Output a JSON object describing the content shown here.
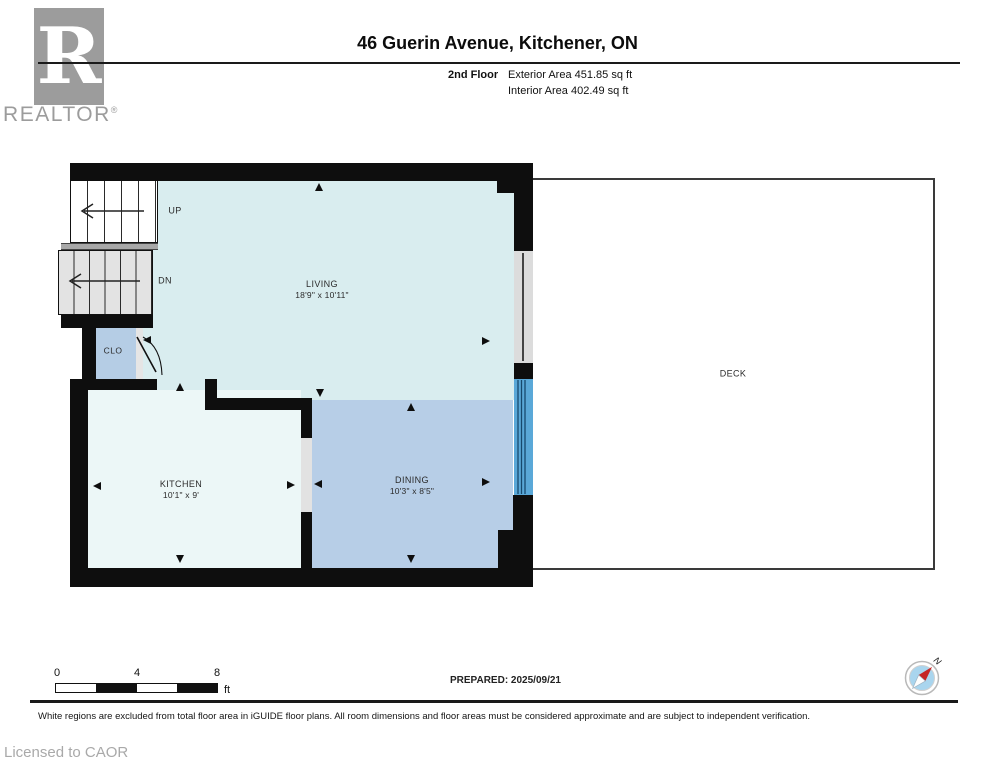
{
  "header": {
    "logo": {
      "letter": "R",
      "brand": "REALTOR",
      "registered": "®"
    },
    "title": "46 Guerin Avenue, Kitchener, ON",
    "floor_label": "2nd Floor",
    "exterior_area": "Exterior Area 451.85 sq ft",
    "interior_area": "Interior Area 402.49 sq ft"
  },
  "floor_plan": {
    "rooms": {
      "living": {
        "name": "LIVING",
        "dims": "18'9\" x 10'11\""
      },
      "dining": {
        "name": "DINING",
        "dims": "10'3\" x 8'5\""
      },
      "kitchen": {
        "name": "KITCHEN",
        "dims": "10'1\" x 9'"
      },
      "closet": {
        "name": "CLO"
      },
      "deck": {
        "name": "DECK"
      }
    },
    "stairs": {
      "up_label": "UP",
      "dn_label": "DN"
    },
    "colors": {
      "living": "#d9edef",
      "dining": "#b7cee7",
      "kitchen": "#ecf7f7",
      "closet": "#b5cde5",
      "sliding_door": "#5aa8d8",
      "window": "#dcdcdc",
      "wall": "#0e0e0e",
      "compass_needle": "#c52525"
    }
  },
  "footer": {
    "scale": {
      "ticks": [
        "0",
        "4",
        "8"
      ],
      "unit": "ft"
    },
    "prepared": "PREPARED: 2025/09/21",
    "compass_label": "N",
    "disclaimer": "White regions are excluded from total floor area in iGUIDE floor plans. All room dimensions and floor areas must be considered approximate and are subject to independent verification.",
    "license": "Licensed to CAOR"
  }
}
